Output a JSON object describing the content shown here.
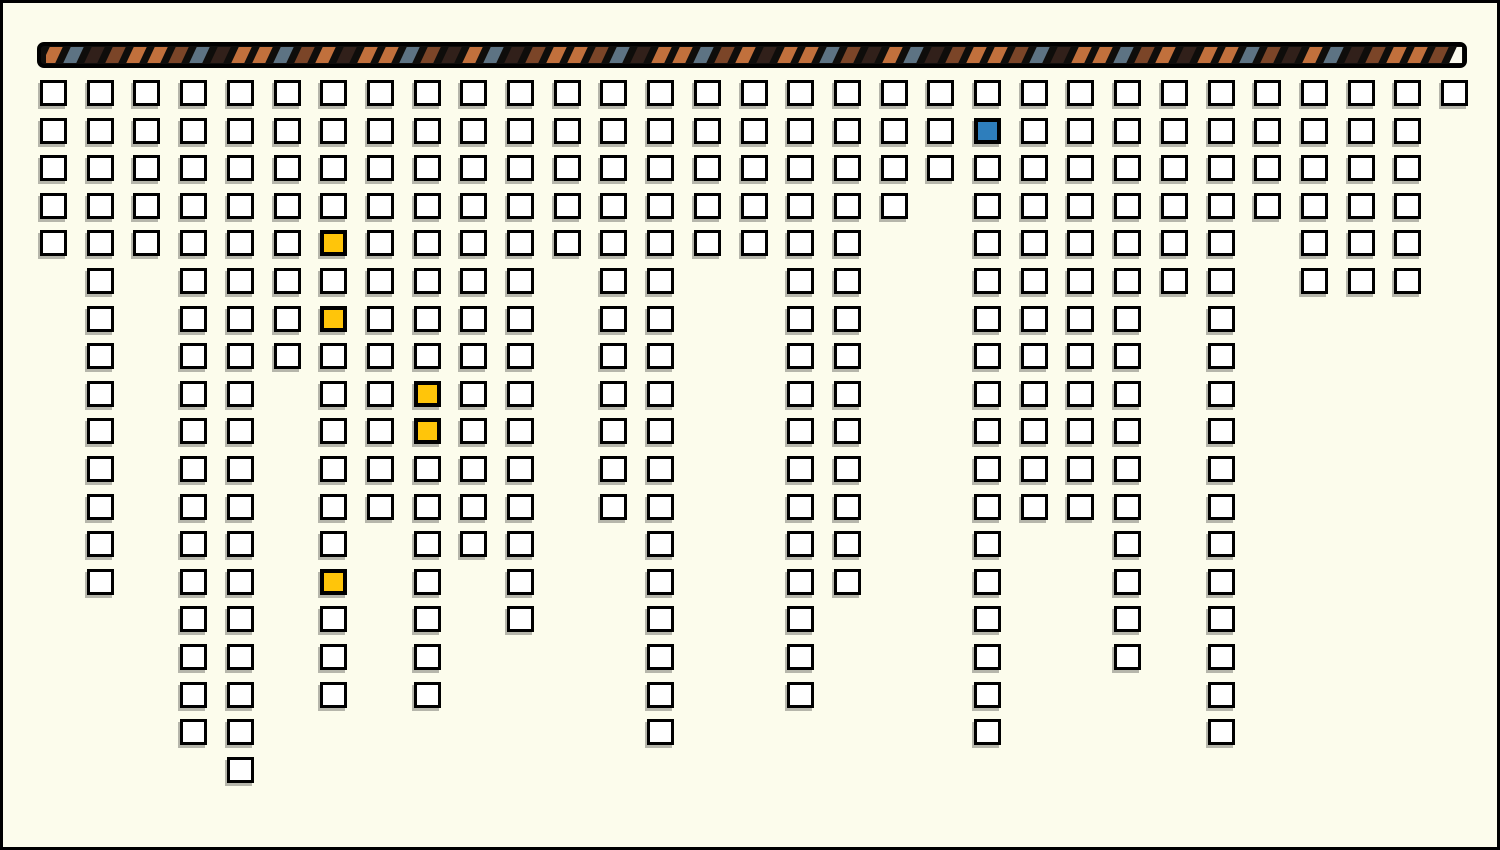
{
  "canvas": {
    "background_color": "#FCFCEC",
    "frame_color": "#000000"
  },
  "progress_bar": {
    "track_color": "#0E0D0B",
    "border_color": "#000000",
    "stripe_colors": {
      "orange": "#C1703C",
      "slate": "#5D7383",
      "brown": "#7B4528",
      "dark": "#31201A",
      "remaining": "#FBFAEE"
    },
    "stripe_cycle": [
      "orange",
      "slate",
      "dark",
      "brown",
      "orange",
      "orange",
      "brown",
      "slate",
      "dark",
      "orange",
      "orange",
      "slate",
      "brown",
      "orange",
      "dark",
      "orange",
      "orange",
      "slate",
      "brown",
      "dark"
    ],
    "segments_total": 68,
    "segments_remaining": 1
  },
  "chart_data": {
    "type": "waffle_columns",
    "title": "",
    "columns": 31,
    "max_rows": 19,
    "column_heights": [
      5,
      14,
      5,
      18,
      19,
      8,
      17,
      12,
      17,
      13,
      15,
      5,
      12,
      18,
      5,
      5,
      17,
      14,
      4,
      3,
      18,
      12,
      12,
      16,
      6,
      18,
      4,
      6,
      6,
      6,
      1
    ],
    "highlighted_cells": [
      {
        "col": 7,
        "row": 5,
        "color": "yellow"
      },
      {
        "col": 7,
        "row": 7,
        "color": "yellow"
      },
      {
        "col": 7,
        "row": 14,
        "color": "yellow"
      },
      {
        "col": 9,
        "row": 9,
        "color": "yellow"
      },
      {
        "col": 9,
        "row": 10,
        "color": "yellow"
      },
      {
        "col": 21,
        "row": 2,
        "color": "blue"
      }
    ],
    "cell_colors": {
      "default": "#FFFFFF",
      "yellow": "#FFC50A",
      "blue": "#2E7EBC",
      "border": "#000000"
    },
    "total_cells": 331,
    "legend": "none",
    "grid_lines": "off"
  }
}
